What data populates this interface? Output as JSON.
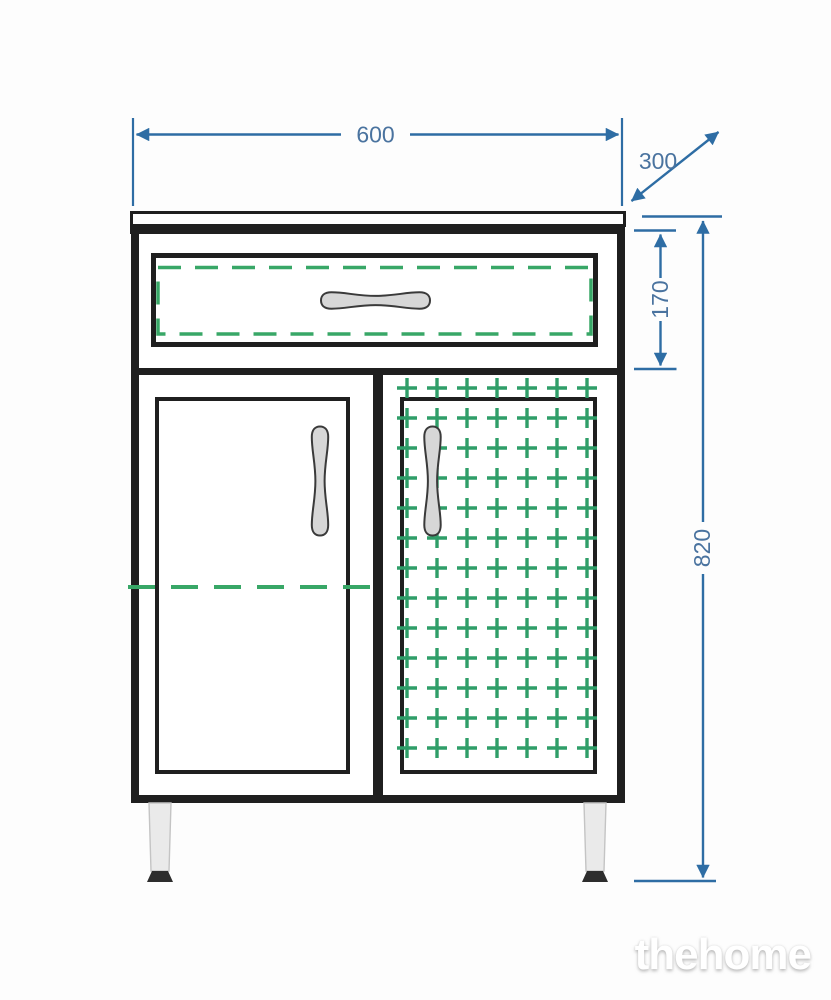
{
  "watermark": {
    "text": "thehome"
  },
  "dimensions": {
    "width": "600",
    "depth": "300",
    "drawer_height": "170",
    "total_height": "820"
  },
  "colors": {
    "background": "#fdfdfd",
    "line_black": "#1f1f1f",
    "dimension_blue": "#2e6da4",
    "dimension_text": "#4a739f",
    "hidden_green": "#38a767",
    "basket_green": "#2f9e68",
    "handle_gray": "#d7d7d7",
    "leg_gray": "#eaeaea",
    "foot_dark": "#2d2d2d",
    "watermark_white": "#ffffff"
  },
  "drawing": {
    "basket_grid": {
      "x_start": 407,
      "x_end": 587,
      "x_step": 30,
      "y_start": 388,
      "y_end": 748,
      "y_step": 30,
      "dash": "20 10",
      "stroke_width": 3.4,
      "overscan": 10
    }
  }
}
